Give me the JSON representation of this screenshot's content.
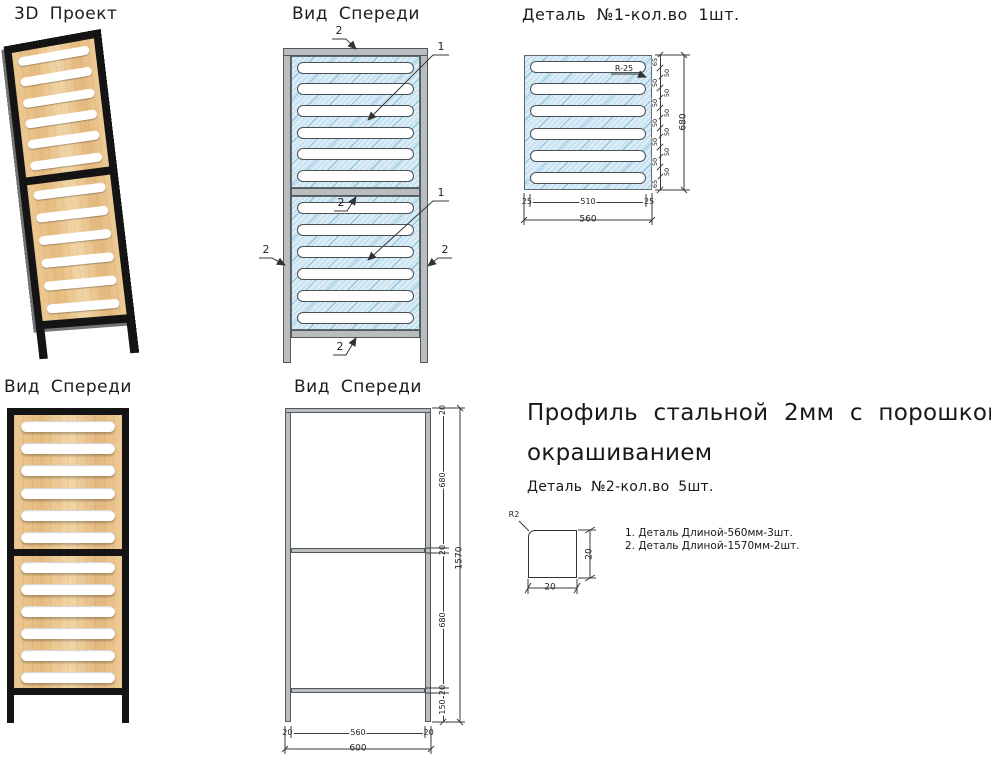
{
  "colors": {
    "hatch_base": "#dcecf6",
    "hatch_accent": "#4f9fca",
    "bar_fill": "#b9bdbf",
    "bar_edge": "#53585a",
    "frame_black": "#141414",
    "wood_light": "#f2d6a8",
    "wood_dark": "#e4b87e",
    "dim": "#3a3a3a"
  },
  "view3d": {
    "title": "3D Проект",
    "slots_per_panel": 6
  },
  "front_view": {
    "title": "Вид Спереди",
    "slots_per_panel": 6,
    "callouts": [
      "2",
      "1",
      "2",
      "1",
      "2",
      "2",
      "2"
    ]
  },
  "detail1": {
    "title": "Деталь №1-кол.во 1шт.",
    "radius_label": "R-25",
    "slots_per_panel": 6,
    "side_chain": [
      "65",
      "50",
      "50",
      "50",
      "50",
      "50",
      "50",
      "50",
      "50",
      "50",
      "50",
      "50",
      "65"
    ],
    "side_total": "680",
    "bottom_chain": [
      "25",
      "510",
      "25"
    ],
    "bottom_total": "560"
  },
  "render_view": {
    "title": "Вид Спереди",
    "slots_per_panel": 6
  },
  "frame_view": {
    "title": "Вид Спереди",
    "side_chain": [
      "20",
      "680",
      "20",
      "680",
      "20",
      "150"
    ],
    "side_total": "1570",
    "bottom_chain": [
      "20",
      "560",
      "20"
    ],
    "bottom_total": "600"
  },
  "spec": {
    "heading_line1": "Профиль стальной 2мм с порошковым",
    "heading_line2": "окрашиванием",
    "subheading": "Деталь №2-кол.во 5шт.",
    "profile_radius": "R2",
    "profile_width": "20",
    "profile_height": "20",
    "notes": [
      "1. Деталь Длиной-560мм-3шт.",
      "2. Деталь Длиной-1570мм-2шт."
    ]
  }
}
